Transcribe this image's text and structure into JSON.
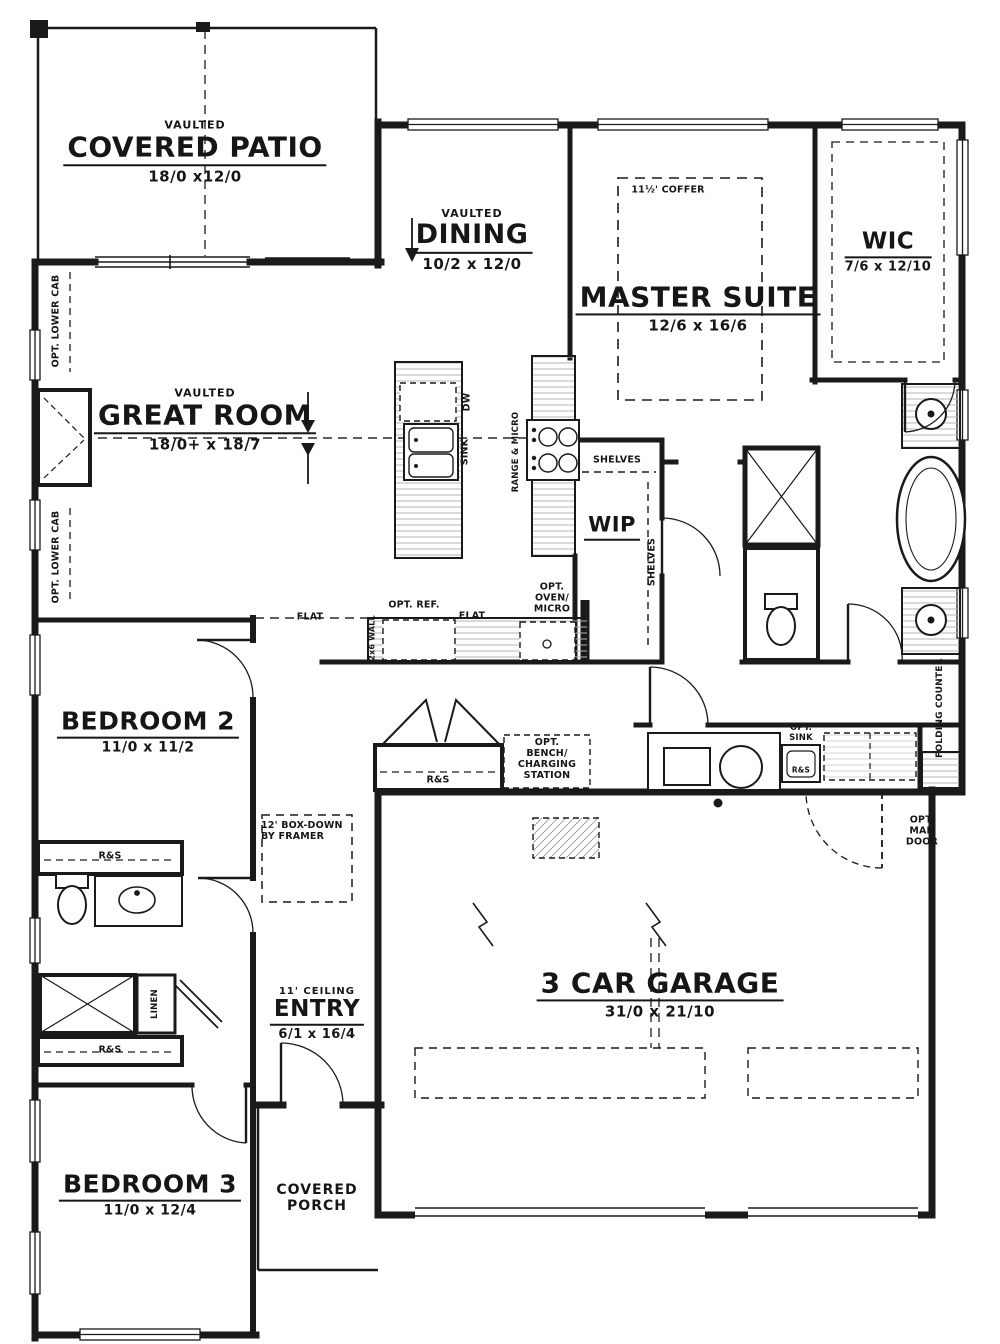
{
  "rooms": {
    "covered_patio": {
      "note": "VAULTED",
      "name": "COVERED PATIO",
      "dims": "18/0 x12/0"
    },
    "dining": {
      "note": "VAULTED",
      "name": "DINING",
      "dims": "10/2 x 12/0"
    },
    "master_suite": {
      "name": "MASTER SUITE",
      "dims": "12/6 x 16/6",
      "coffer": "11½' COFFER"
    },
    "wic": {
      "name": "WIC",
      "dims": "7/6 x 12/10"
    },
    "great_room": {
      "note": "VAULTED",
      "name": "GREAT ROOM",
      "dims": "18/0+ x 18/7"
    },
    "wip": {
      "name": "WIP"
    },
    "bedroom_2": {
      "name": "BEDROOM 2",
      "dims": "11/0 x 11/2"
    },
    "bedroom_3": {
      "name": "BEDROOM 3",
      "dims": "11/0 x 12/4"
    },
    "entry": {
      "note": "11' CEILING",
      "name": "ENTRY",
      "dims": "6/1 x 16/4"
    },
    "garage": {
      "name": "3 CAR GARAGE",
      "dims": "31/0 x 21/10"
    },
    "covered_porch": {
      "name": "COVERED PORCH"
    }
  },
  "annotations": {
    "opt_lower_cab": "OPT. LOWER CAB",
    "shelves": "SHELVES",
    "dw": "DW",
    "sink": "SINK",
    "range_micro": "RANGE & MICRO",
    "flat": "FLAT",
    "opt_ref": "OPT. REF.",
    "opt_oven_micro": "OPT. OVEN/ MICRO",
    "wall_2x6": "2x6 WALL",
    "rod_shelf": "R&S",
    "opt_bench": "OPT. BENCH/ CHARGING STATION",
    "opt_sink": "OPT. SINK",
    "folding_counter": "FOLDING COUNTER",
    "opt_man_door": "OPT. MAN DOOR",
    "box_down": "12' BOX-DOWN BY FRAMER",
    "linen": "LINEN"
  }
}
